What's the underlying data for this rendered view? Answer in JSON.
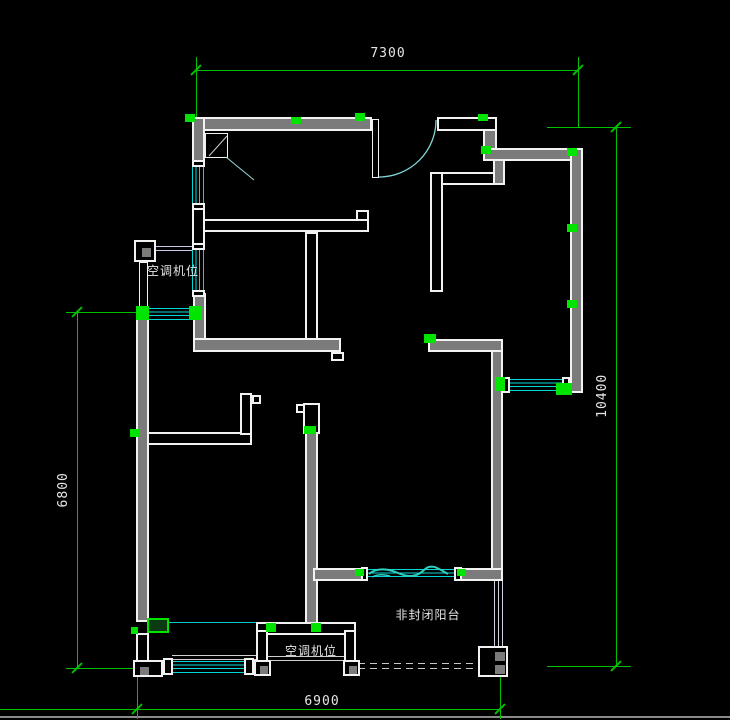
{
  "canvas": {
    "width": 730,
    "height": 720,
    "background": "#000000"
  },
  "palette": {
    "wall_outline": "#f2f2f2",
    "wall_fill_selected": "#7b7b7b",
    "window_cyan": "#00d8d8",
    "wave_turquoise": "#2fd0c0",
    "dimension_green": "#00c000",
    "grip_green": "#00e400",
    "text": "#e6e6e6"
  },
  "labels": {
    "ac_top": "空调机位",
    "ac_bottom": "空调机位",
    "balcony": "非封闭阳台"
  },
  "dimensions": {
    "top": "7300",
    "right": "10400",
    "left": "6800",
    "bottom": "6900"
  },
  "geometry": {
    "windows": [
      [
        192,
        165,
        13,
        40,
        "v"
      ],
      [
        192,
        248,
        13,
        44,
        "v"
      ],
      [
        149,
        308,
        43,
        12,
        "h"
      ],
      [
        508,
        379,
        55,
        13,
        "h"
      ],
      [
        367,
        569,
        88,
        11,
        "h"
      ],
      [
        172,
        661,
        73,
        12,
        "h"
      ]
    ],
    "walls": [
      [
        196,
        117,
        176,
        14,
        "gray",
        "top-wall-west"
      ],
      [
        437,
        117,
        60,
        14,
        "hollow",
        "top-wall-entry-east"
      ],
      [
        483,
        129,
        14,
        21,
        "gray",
        "top-corner-stub"
      ],
      [
        483,
        148,
        100,
        13,
        "gray",
        "top-wall-east"
      ],
      [
        570,
        148,
        13,
        245,
        "gray",
        "right-exterior-wall"
      ],
      [
        192,
        117,
        13,
        48,
        "gray",
        "left-wall-upper"
      ],
      [
        192,
        206,
        13,
        44,
        "hollow",
        "left-wall-mid"
      ],
      [
        193,
        293,
        13,
        50,
        "gray",
        "left-wall-lower"
      ],
      [
        193,
        338,
        148,
        14,
        "gray",
        "l-wall-horizontal"
      ],
      [
        331,
        352,
        13,
        9,
        "hollow",
        "l-wall-stub"
      ],
      [
        203,
        219,
        166,
        13,
        "hollow",
        "hall-wall-horizontal"
      ],
      [
        356,
        210,
        13,
        11,
        "hollow",
        "hall-wall-cap"
      ],
      [
        305,
        232,
        13,
        108,
        "hollow",
        "hall-wall-vertical"
      ],
      [
        430,
        172,
        13,
        120,
        "hollow",
        "kitchen-wall-vertical"
      ],
      [
        441,
        172,
        64,
        13,
        "hollow",
        "kitchen-wall-horizontal"
      ],
      [
        493,
        159,
        12,
        26,
        "gray",
        "kitchen-wall-connector"
      ],
      [
        428,
        339,
        75,
        13,
        "gray",
        "mid-wall-horizontal"
      ],
      [
        491,
        350,
        12,
        223,
        "gray",
        "mid-wall-vertical"
      ],
      [
        140,
        432,
        112,
        13,
        "hollow",
        "bedroom2-top-wall"
      ],
      [
        240,
        393,
        12,
        42,
        "hollow",
        "bedroom2-jamb"
      ],
      [
        252,
        395,
        9,
        9,
        "hollow",
        "bedroom2-jamb-cap"
      ],
      [
        303,
        403,
        17,
        31,
        "hollow",
        "bottom-wall-cap"
      ],
      [
        296,
        404,
        9,
        9,
        "hollow",
        "bottom-wall-notch"
      ],
      [
        305,
        432,
        13,
        203,
        "gray",
        "bottom-mid-wall"
      ],
      [
        313,
        568,
        50,
        13,
        "gray",
        "balcony-wall-west"
      ],
      [
        458,
        568,
        45,
        13,
        "gray",
        "balcony-wall-east"
      ],
      [
        136,
        310,
        13,
        312,
        "gray",
        "left-exterior-wall"
      ],
      [
        136,
        633,
        13,
        29,
        "hollow",
        "left-wall-bottom"
      ],
      [
        139,
        262,
        9,
        48,
        "thin",
        "ac-platform-wall"
      ],
      [
        256,
        622,
        100,
        13,
        "hollow",
        "acbox-top-wall"
      ],
      [
        256,
        630,
        12,
        34,
        "hollow",
        "acbox-left-wall"
      ],
      [
        344,
        630,
        12,
        34,
        "hollow",
        "acbox-right-wall"
      ],
      [
        503,
        377,
        7,
        16,
        "hollow",
        "window-cap"
      ],
      [
        562,
        377,
        8,
        16,
        "hollow",
        "window-cap"
      ],
      [
        361,
        567,
        7,
        14,
        "hollow",
        "window-cap"
      ],
      [
        454,
        567,
        8,
        14,
        "hollow",
        "window-cap"
      ],
      [
        163,
        658,
        10,
        17,
        "hollow",
        "window-cap"
      ],
      [
        244,
        658,
        10,
        17,
        "hollow",
        "window-cap"
      ],
      [
        192,
        160,
        13,
        7,
        "hollow",
        "window-cap"
      ],
      [
        192,
        203,
        13,
        7,
        "hollow",
        "window-cap"
      ],
      [
        192,
        243,
        13,
        7,
        "hollow",
        "window-cap"
      ],
      [
        192,
        290,
        13,
        7,
        "hollow",
        "window-cap"
      ],
      [
        372,
        119,
        7,
        59,
        "thin",
        "entry-door-leaf"
      ],
      [
        205,
        133,
        23,
        25,
        "thin",
        "closet-symbol"
      ]
    ],
    "posts": [
      [
        134,
        240,
        22,
        22,
        [
          [
            6,
            6,
            9,
            9
          ]
        ],
        "ac-platform-box"
      ],
      [
        133,
        660,
        30,
        17,
        [
          [
            5,
            5,
            9,
            8
          ]
        ],
        "corner-post-sw"
      ],
      [
        254,
        660,
        17,
        16,
        [
          [
            4,
            4,
            8,
            8
          ]
        ],
        "acbox-post-left"
      ],
      [
        343,
        660,
        17,
        16,
        [
          [
            4,
            4,
            8,
            8
          ]
        ],
        "acbox-post-right"
      ],
      [
        478,
        646,
        30,
        31,
        [
          [
            15,
            4,
            10,
            9
          ],
          [
            15,
            17,
            10,
            9
          ]
        ],
        "balcony-post-se"
      ]
    ],
    "rails": [
      [
        148,
        246,
        44,
        1,
        "#c8c8e8"
      ],
      [
        148,
        250,
        44,
        1,
        "#c8c8e8"
      ],
      [
        494,
        580,
        1,
        67,
        "#d0d0e0"
      ],
      [
        498,
        580,
        1,
        67,
        "#d0d0e0"
      ],
      [
        502,
        580,
        1,
        67,
        "#d0d0e0"
      ],
      [
        172,
        655,
        84,
        1,
        "#cfcfcf"
      ],
      [
        172,
        659,
        84,
        1,
        "#cfcfcf"
      ],
      [
        268,
        656,
        76,
        1,
        "#cfcfcf"
      ],
      [
        268,
        660,
        76,
        1,
        "#cfcfcf"
      ],
      [
        358,
        663,
        121,
        1,
        "#c8c8c8",
        "dash"
      ],
      [
        358,
        668,
        121,
        1,
        "#c8c8c8",
        "dash"
      ],
      [
        167,
        622,
        91,
        1,
        "#00c8c8"
      ],
      [
        0,
        716,
        730,
        2,
        "#8a8a8a"
      ]
    ],
    "grips": [
      [
        185,
        114,
        10,
        8
      ],
      [
        291,
        117,
        10,
        7
      ],
      [
        355,
        113,
        10,
        8
      ],
      [
        478,
        114,
        10,
        7
      ],
      [
        481,
        146,
        10,
        8
      ],
      [
        567,
        224,
        10,
        8
      ],
      [
        567,
        300,
        10,
        8
      ],
      [
        567,
        148,
        10,
        8
      ],
      [
        495,
        377,
        10,
        14
      ],
      [
        556,
        383,
        16,
        12
      ],
      [
        424,
        334,
        12,
        9
      ],
      [
        304,
        426,
        12,
        8
      ],
      [
        266,
        623,
        10,
        9
      ],
      [
        311,
        623,
        10,
        9
      ],
      [
        130,
        429,
        10,
        8
      ],
      [
        131,
        627,
        7,
        7
      ],
      [
        136,
        306,
        13,
        14
      ],
      [
        189,
        306,
        13,
        14
      ],
      [
        355,
        569,
        9,
        7
      ],
      [
        457,
        569,
        9,
        7
      ]
    ],
    "grip_boxes": [
      [
        147,
        618,
        22,
        15
      ]
    ],
    "dim_lines": [
      [
        196,
        70,
        383,
        1
      ],
      [
        196,
        57,
        1,
        66
      ],
      [
        578,
        57,
        1,
        71
      ],
      [
        616,
        127,
        1,
        540
      ],
      [
        547,
        127,
        84,
        1
      ],
      [
        547,
        666,
        84,
        1
      ],
      [
        77,
        312,
        1,
        357
      ],
      [
        66,
        312,
        71,
        1
      ],
      [
        66,
        668,
        68,
        1
      ],
      [
        0,
        709,
        501,
        1
      ],
      [
        137,
        675,
        1,
        44
      ],
      [
        500,
        677,
        1,
        42
      ]
    ],
    "dim_ticks": [
      [
        196,
        70
      ],
      [
        578,
        70
      ],
      [
        616,
        127
      ],
      [
        616,
        666
      ],
      [
        77,
        312
      ],
      [
        77,
        668
      ],
      [
        137,
        709
      ],
      [
        500,
        709
      ]
    ],
    "svg_paths": [
      {
        "name": "entry-door-swing-arc",
        "d": "M 379 177 A 57 57 0 0 0 436 120",
        "stroke": "#7fd6d6",
        "w": 1.3
      },
      {
        "name": "closet-diagonal",
        "d": "M 227 136 L 209 156",
        "stroke": "#cccccc",
        "w": 1
      },
      {
        "name": "closet-swing-line",
        "d": "M 226 157 L 254 180",
        "stroke": "#9adada",
        "w": 1
      },
      {
        "name": "balcony-window-wave",
        "d": "M 369 574 C 377 567 389 569 398 573 S 416 578 424 570 S 440 570 448 574",
        "stroke": "#2fd0c0",
        "w": 2
      },
      {
        "name": "balcony-window-wave-small",
        "d": "M 372 577 Q 380 573 390 576",
        "stroke": "#2fd0c0",
        "w": 1.5
      }
    ]
  }
}
